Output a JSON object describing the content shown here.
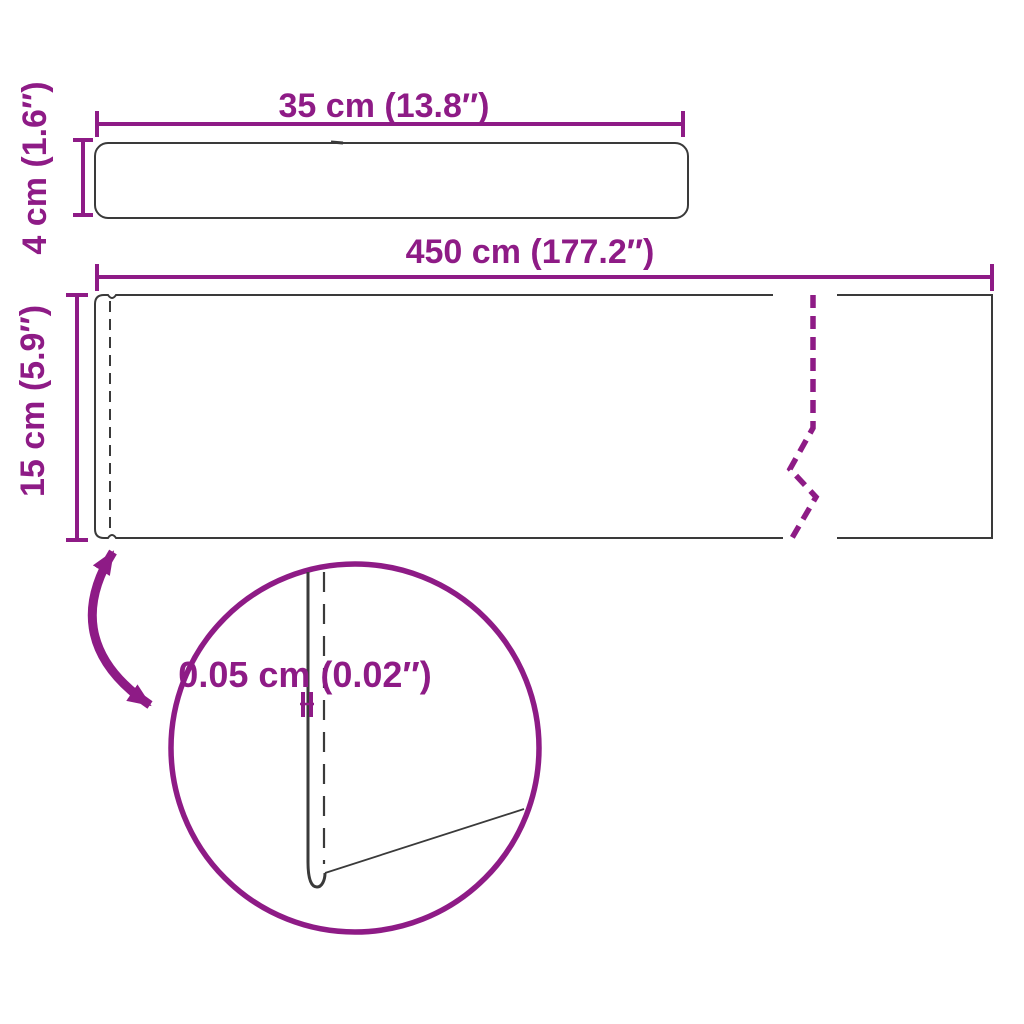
{
  "colors": {
    "accent": "#8E1B86",
    "outline": "#3A3A3A",
    "background": "#FFFFFF"
  },
  "diagram": {
    "kind": "product-dimension-diagram",
    "top_strip": {
      "width_label": "35 cm (13.8″)",
      "height_label": "4 cm (1.6″)"
    },
    "main_strip": {
      "width_label": "450 cm (177.2″)",
      "height_label": "15 cm (5.9″)"
    },
    "detail": {
      "thickness_label": "0.05 cm (0.02″)"
    }
  }
}
